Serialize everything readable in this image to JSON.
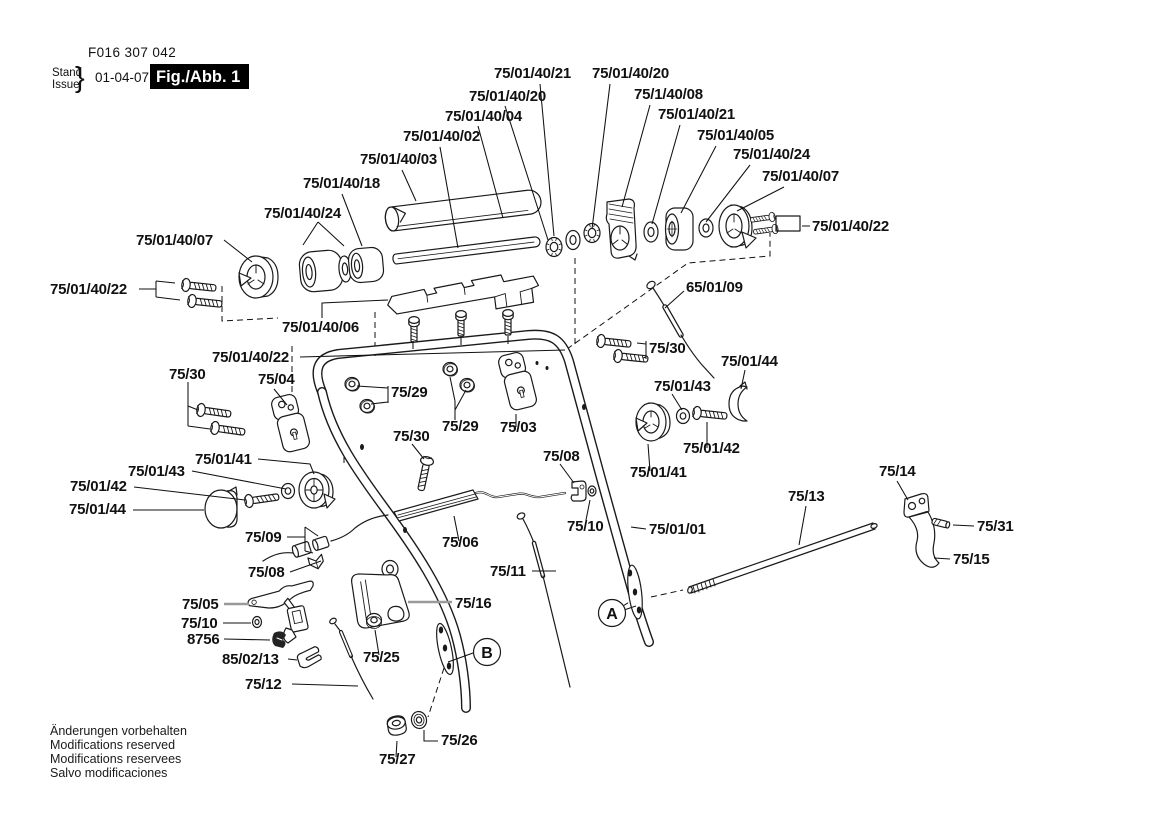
{
  "doc": {
    "part_number": "F016 307 042",
    "stand_label": "Stand",
    "issue_label": "Issue",
    "brace": "}",
    "issue_date": "01-04-07",
    "figure_label": "Fig./Abb. 1",
    "footer_lines": [
      "Änderungen vorbehalten",
      "Modifications reserved",
      "Modifications reservees",
      "Salvo modificaciones"
    ]
  },
  "callouts": {
    "a": "A",
    "b": "B"
  },
  "labels": [
    {
      "id": "top-1",
      "text": "75/01/40/21"
    },
    {
      "id": "top-2",
      "text": "75/01/40/20"
    },
    {
      "id": "top-3",
      "text": "75/01/40/20"
    },
    {
      "id": "top-4",
      "text": "75/1/40/08"
    },
    {
      "id": "top-5",
      "text": "75/01/40/04"
    },
    {
      "id": "top-6",
      "text": "75/01/40/21"
    },
    {
      "id": "top-7",
      "text": "75/01/40/02"
    },
    {
      "id": "top-8",
      "text": "75/01/40/05"
    },
    {
      "id": "top-9",
      "text": "75/01/40/03"
    },
    {
      "id": "top-10",
      "text": "75/01/40/24"
    },
    {
      "id": "top-11",
      "text": "75/01/40/18"
    },
    {
      "id": "top-12",
      "text": "75/01/40/07"
    },
    {
      "id": "left-24",
      "text": "75/01/40/24"
    },
    {
      "id": "left-07",
      "text": "75/01/40/07"
    },
    {
      "id": "right-22",
      "text": "75/01/40/22"
    },
    {
      "id": "left-22",
      "text": "75/01/40/22"
    },
    {
      "id": "cable-65",
      "text": "65/01/09"
    },
    {
      "id": "housing-06",
      "text": "75/01/40/06"
    },
    {
      "id": "mid-22",
      "text": "75/01/40/22"
    },
    {
      "id": "screw-30a",
      "text": "75/30"
    },
    {
      "id": "bracket-04",
      "text": "75/04"
    },
    {
      "id": "nut-29a",
      "text": "75/29"
    },
    {
      "id": "screw-30b",
      "text": "75/30"
    },
    {
      "id": "cover-44r",
      "text": "75/01/44"
    },
    {
      "id": "washer-43r",
      "text": "75/01/43"
    },
    {
      "id": "nut-29b",
      "text": "75/29"
    },
    {
      "id": "bracket-03",
      "text": "75/03"
    },
    {
      "id": "screw-30c",
      "text": "75/30"
    },
    {
      "id": "screw-42r",
      "text": "75/01/42"
    },
    {
      "id": "pulley-41r",
      "text": "75/01/41"
    },
    {
      "id": "clamp-08r",
      "text": "75/08"
    },
    {
      "id": "washer-43l",
      "text": "75/01/43"
    },
    {
      "id": "pulley-41l",
      "text": "75/01/41"
    },
    {
      "id": "screw-42l",
      "text": "75/01/42"
    },
    {
      "id": "cover-44l",
      "text": "75/01/44"
    },
    {
      "id": "trigger-14",
      "text": "75/14"
    },
    {
      "id": "rod-13",
      "text": "75/13"
    },
    {
      "id": "washer-10r",
      "text": "75/10"
    },
    {
      "id": "tube-01",
      "text": "75/01/01"
    },
    {
      "id": "pin-31",
      "text": "75/31"
    },
    {
      "id": "bushings-09",
      "text": "75/09"
    },
    {
      "id": "trigger-15",
      "text": "75/15"
    },
    {
      "id": "rod-06",
      "text": "75/06"
    },
    {
      "id": "clamp-08l",
      "text": "75/08"
    },
    {
      "id": "cable-11",
      "text": "75/11"
    },
    {
      "id": "bracket-16",
      "text": "75/16"
    },
    {
      "id": "lever-05",
      "text": "75/05"
    },
    {
      "id": "washer-10l",
      "text": "75/10"
    },
    {
      "id": "hook-8756",
      "text": "8756"
    },
    {
      "id": "clip-8502",
      "text": "85/02/13"
    },
    {
      "id": "nut-25",
      "text": "75/25"
    },
    {
      "id": "cable-12",
      "text": "75/12"
    },
    {
      "id": "washer-26",
      "text": "75/26"
    },
    {
      "id": "nut-27",
      "text": "75/27"
    }
  ]
}
